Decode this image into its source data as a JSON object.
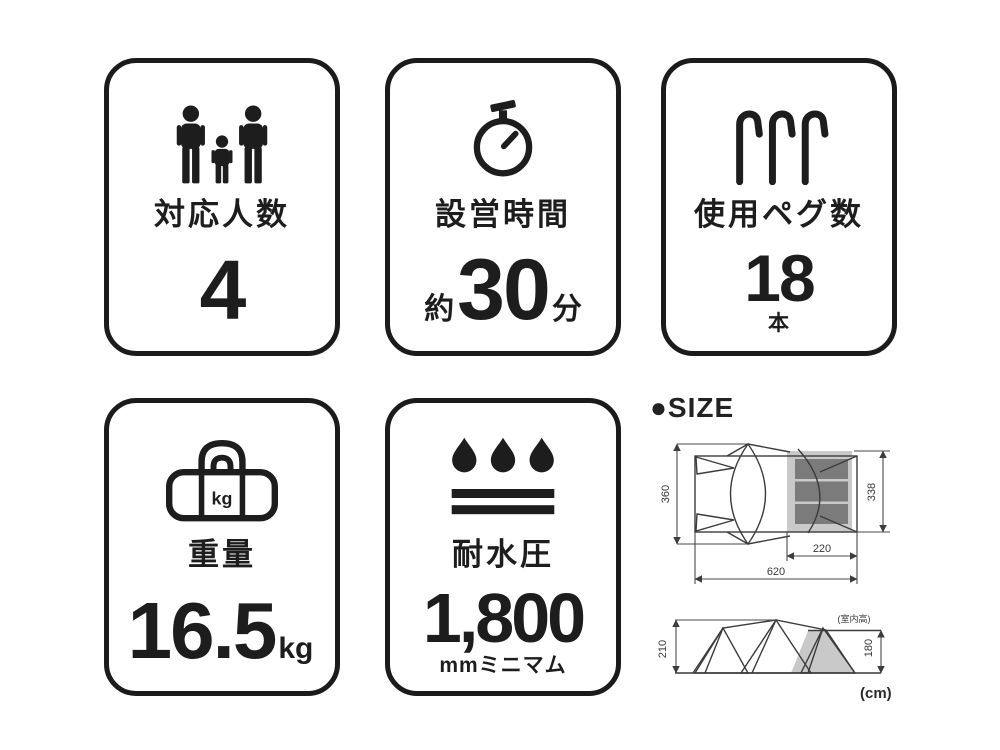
{
  "colors": {
    "ink": "#1d1d1d",
    "border": "#1b1b1b",
    "diagram_line": "#3c3c3c",
    "light_gray": "#c9c9c9",
    "dark_gray": "#7b7b7b",
    "background": "#ffffff"
  },
  "cards": [
    {
      "icon": "family-icon",
      "label": "対応人数",
      "value": "4"
    },
    {
      "icon": "stopwatch-icon",
      "label": "設営時間",
      "prefix": "約",
      "value": "30",
      "suffix": "分"
    },
    {
      "icon": "tent-pegs-icon",
      "label": "使用ペグ数",
      "value": "18",
      "unit_below": "本"
    },
    {
      "icon": "duffel-bag-icon",
      "icon_text": "kg",
      "label": "重量",
      "value": "16.5",
      "suffix": "kg"
    },
    {
      "icon": "water-drops-icon",
      "label": "耐水圧",
      "value": "1,800",
      "unit_below": "mmミニマム"
    }
  ],
  "size_section": {
    "heading": "●SIZE",
    "unit_note": "(cm)",
    "top_view": {
      "total_depth": "360",
      "inner_room_depth": "338",
      "inner_room_width": "220",
      "total_width": "620"
    },
    "side_view": {
      "total_height": "210",
      "inner_room_height": "180",
      "inner_room_height_note": "(室内高)"
    }
  }
}
